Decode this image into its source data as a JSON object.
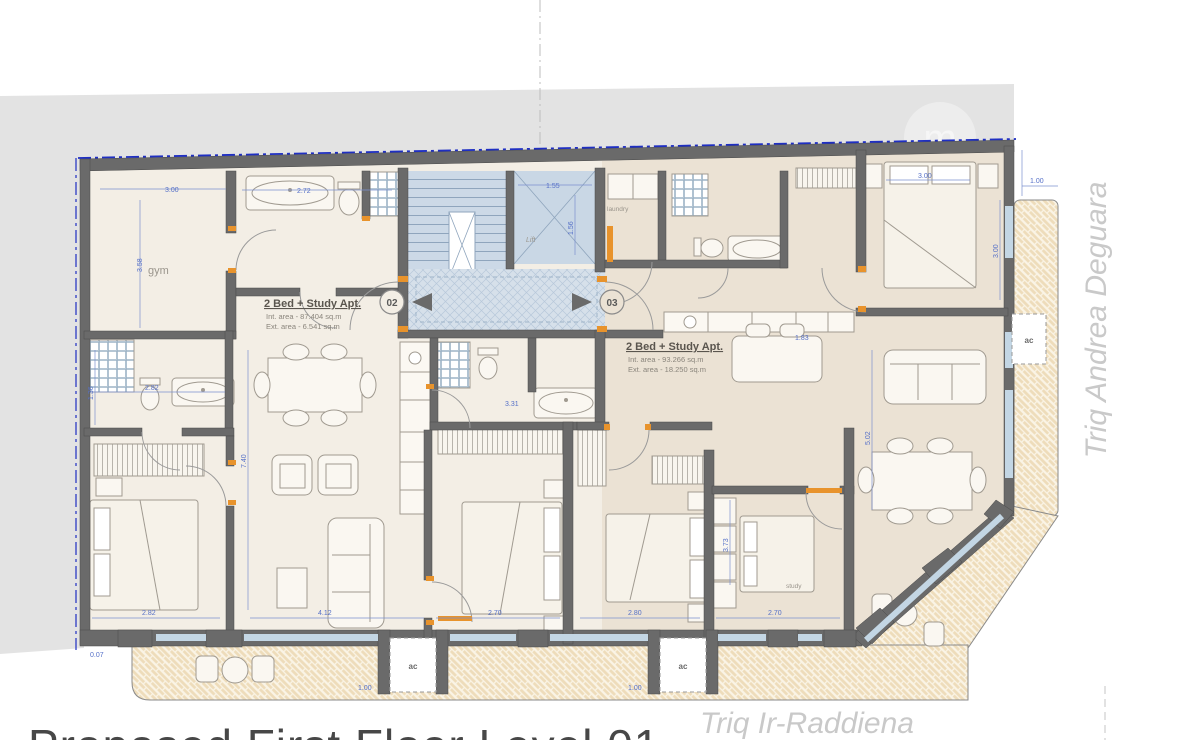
{
  "plan": {
    "title_partial": "Proposed First Floor Level 01",
    "streets": {
      "bottom": "Triq Ir-Raddiena",
      "right": "Triq Andrea Deguara"
    },
    "units": [
      {
        "id": "02",
        "name": "2 Bed + Study Apt.",
        "int_area": "Int. area - 87.404 sq.m",
        "ext_area": "Ext. area - 6.541 sq.m"
      },
      {
        "id": "03",
        "name": "2 Bed + Study Apt.",
        "int_area": "Int. area - 93.266 sq.m",
        "ext_area": "Ext. area - 18.250 sq.m"
      }
    ],
    "rooms": {
      "gym": "gym",
      "laundry": "laundry",
      "study": "study",
      "lift": "Lift"
    },
    "ac_label": "ac",
    "watermark": "m",
    "dims": [
      "3.00",
      "3.58",
      "2.72",
      "1.55",
      "1.56",
      "2.82",
      "1.36",
      "7.40",
      "4.12",
      "2.70",
      "2.80",
      "2.70",
      "3.73",
      "5.02",
      "1.83",
      "3.00",
      "1.00",
      "3.31",
      "0.07",
      "1.00",
      "1.00",
      "3.00",
      "2.82"
    ],
    "colors": {
      "wall": "#6a6a6a",
      "accent_orange": "#e8932c",
      "boundary_blue": "#1f2fc2",
      "dim_blue": "#5570c8",
      "terrace": "#eedcba",
      "core_blue": "#ccd9e7",
      "site_gray": "#e3e3e3"
    }
  }
}
